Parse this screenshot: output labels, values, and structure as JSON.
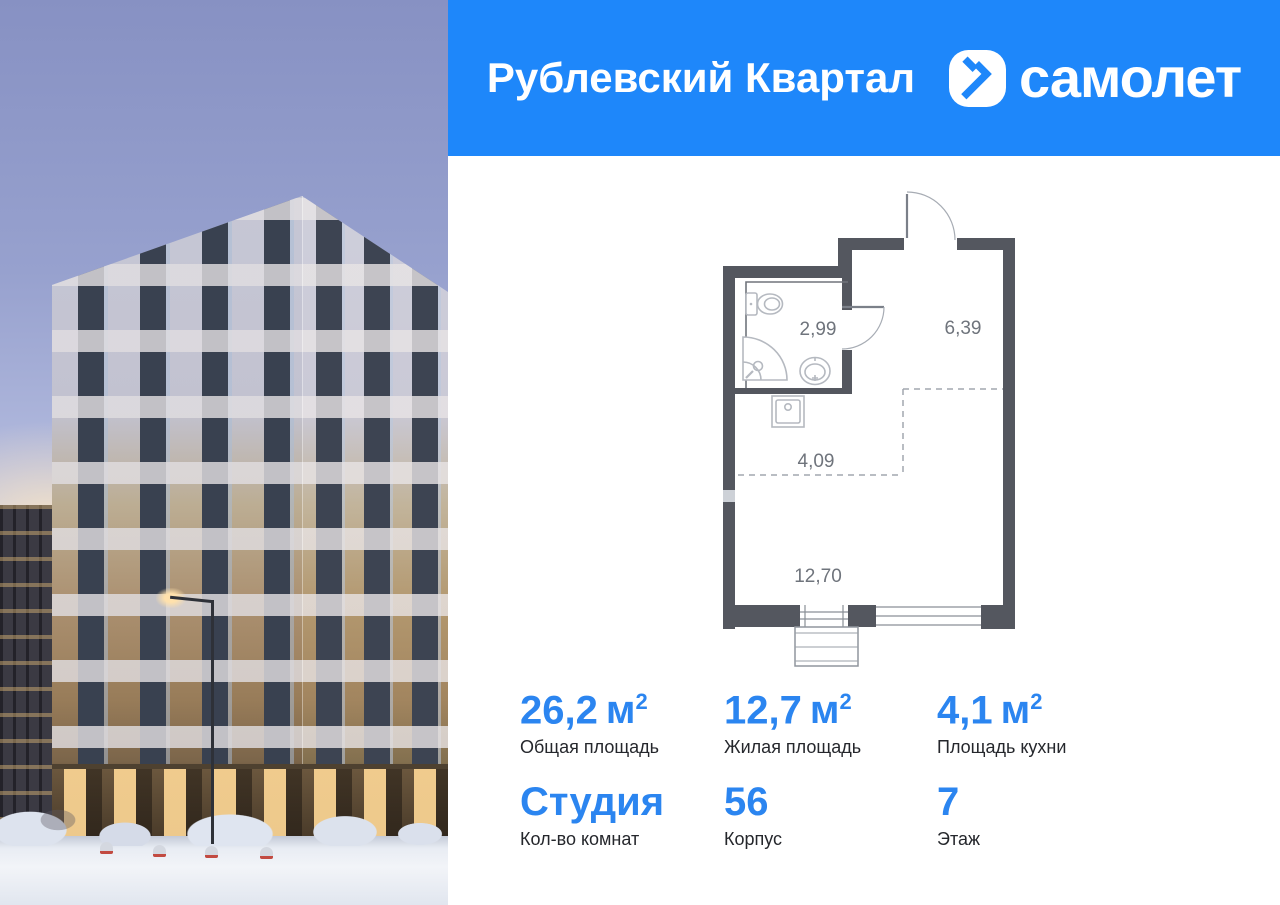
{
  "header": {
    "project_title": "Рублевский Квартал",
    "brand_wordmark": "самолет"
  },
  "floorplan": {
    "rooms": {
      "bathroom_area": "2,99",
      "hallway_area": "6,39",
      "kitchen_area": "4,09",
      "living_area": "12,70"
    }
  },
  "stats": {
    "total_area": {
      "value": "26,2",
      "unit": "м",
      "sup": "2",
      "label": "Общая площадь"
    },
    "living_area": {
      "value": "12,7",
      "unit": "м",
      "sup": "2",
      "label": "Жилая площадь"
    },
    "kitchen_area": {
      "value": "4,1",
      "unit": "м",
      "sup": "2",
      "label": "Площадь кухни"
    },
    "rooms": {
      "value": "Студия",
      "label": "Кол-во комнат"
    },
    "building": {
      "value": "56",
      "label": "Корпус"
    },
    "floor": {
      "value": "7",
      "label": "Этаж"
    }
  },
  "colors": {
    "brand_blue": "#1e87fa",
    "stat_blue": "#2b85f0",
    "plan_wall": "#54575f",
    "plan_label": "#6f747c",
    "text_dark": "#25272c",
    "white": "#ffffff"
  }
}
